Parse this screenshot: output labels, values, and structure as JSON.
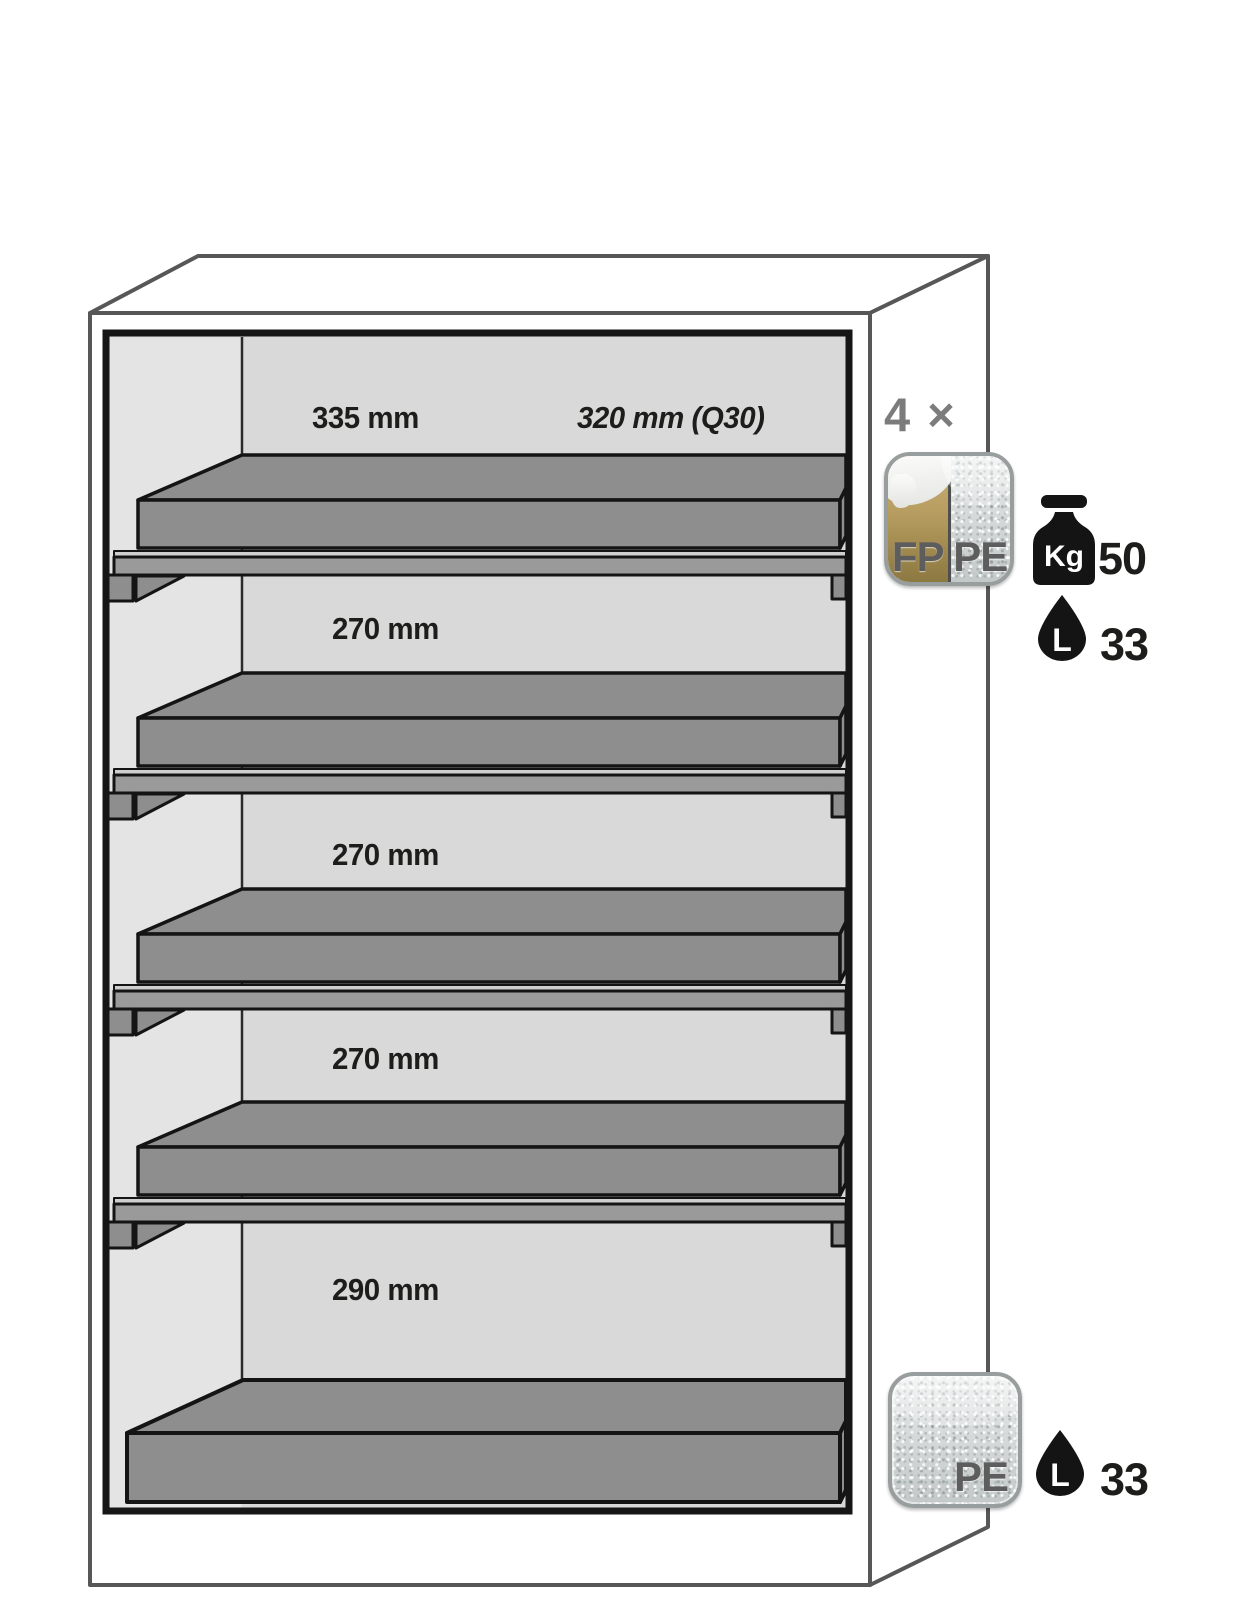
{
  "diagram": {
    "title": "safety cabinet interior equipment diagram",
    "compartments": [
      {
        "height_label": "335 mm",
        "depth_label": "320 mm (Q30)"
      },
      {
        "height_label": "270 mm"
      },
      {
        "height_label": "270 mm"
      },
      {
        "height_label": "270 mm"
      },
      {
        "height_label": "290 mm"
      }
    ]
  },
  "legend": {
    "shelf_count_label": "4 ×",
    "shelf_badge": {
      "left_label": "FP",
      "right_label": "PE"
    },
    "shelf_load": {
      "icon": "weight-icon",
      "unit_label": "Kg",
      "value": "50"
    },
    "shelf_volume": {
      "icon": "drop-icon",
      "unit_label": "L",
      "value": "33"
    },
    "sump_badge": {
      "label": "PE"
    },
    "sump_volume": {
      "icon": "drop-icon",
      "unit_label": "L",
      "value": "33"
    }
  },
  "colors": {
    "tray_gray": "#8e8e8e",
    "wall_gray": "#d9d9d9",
    "sidewall_gray": "#e4e4e4",
    "outline_gray": "#575757",
    "frame_black": "#161616",
    "badge_gold": "#b49a5e",
    "icon_black": "#141414",
    "label_black": "#1d1d1b",
    "muted_gray": "#7c7c7c"
  }
}
